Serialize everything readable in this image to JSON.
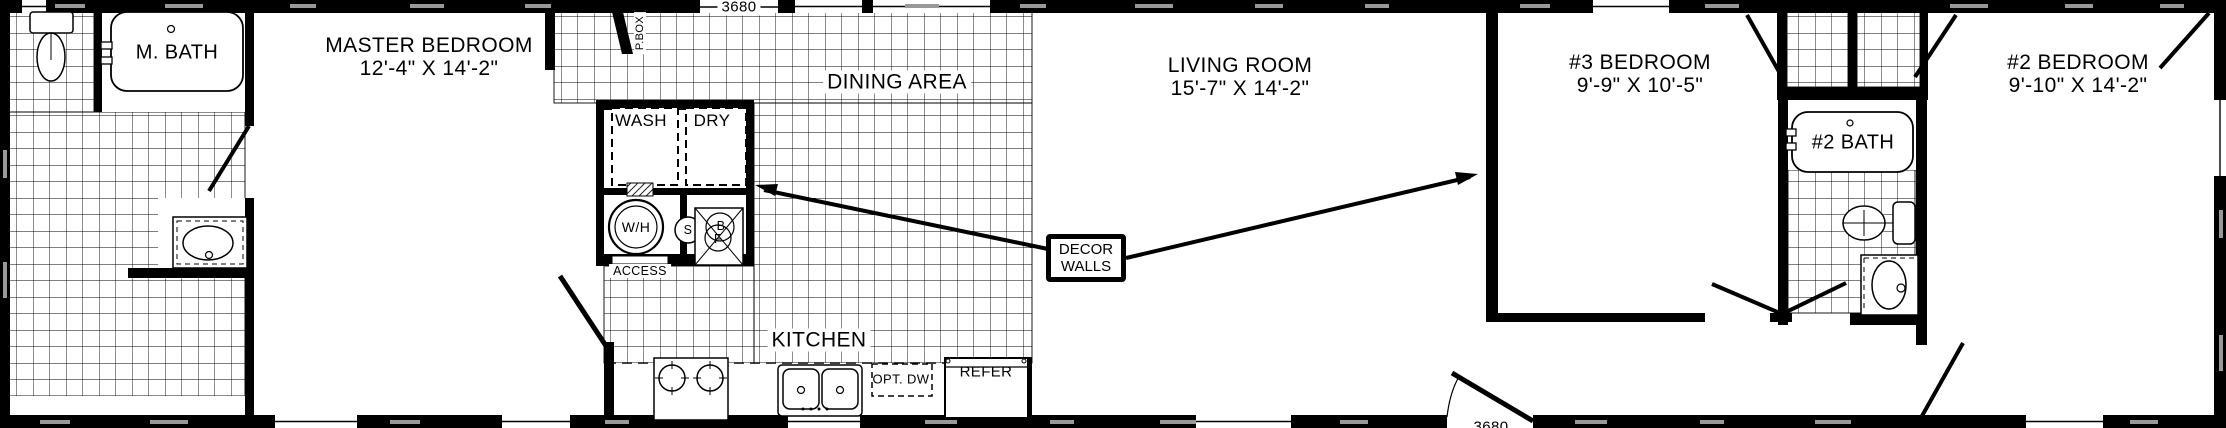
{
  "colors": {
    "ink": "#000000",
    "paper": "#ffffff",
    "wall_dash": "#999999"
  },
  "rooms": {
    "master_bath": {
      "label": "M. BATH"
    },
    "master_bedroom": {
      "label": "MASTER BEDROOM",
      "dims": "12'-4\" X 14'-2\""
    },
    "dining_area": {
      "label": "DINING AREA"
    },
    "living_room": {
      "label": "LIVING ROOM",
      "dims": "15'-7\" X 14'-2\""
    },
    "kitchen": {
      "label": "KITCHEN"
    },
    "bedroom_3": {
      "label": "#3 BEDROOM",
      "dims": "9'-9\" X 10'-5\""
    },
    "bedroom_2": {
      "label": "#2 BEDROOM",
      "dims": "9'-10\" X 14'-2\""
    },
    "bath_2": {
      "label": "#2 BATH"
    }
  },
  "utility": {
    "p_box": "P.BOX",
    "washer": "WASH",
    "dryer": "DRY",
    "water_heater": "W/H",
    "s_unit": "S",
    "b_unit": "B",
    "f_unit": "F",
    "access_panel": "ACCESS"
  },
  "kitchen_fixtures": {
    "optional_dishwasher": "OPT. DW",
    "refrigerator": "REFER"
  },
  "callout": {
    "line1": "DECOR",
    "line2": "WALLS"
  },
  "doors": {
    "front_door_size": "3680",
    "rear_door_size": "3680"
  }
}
